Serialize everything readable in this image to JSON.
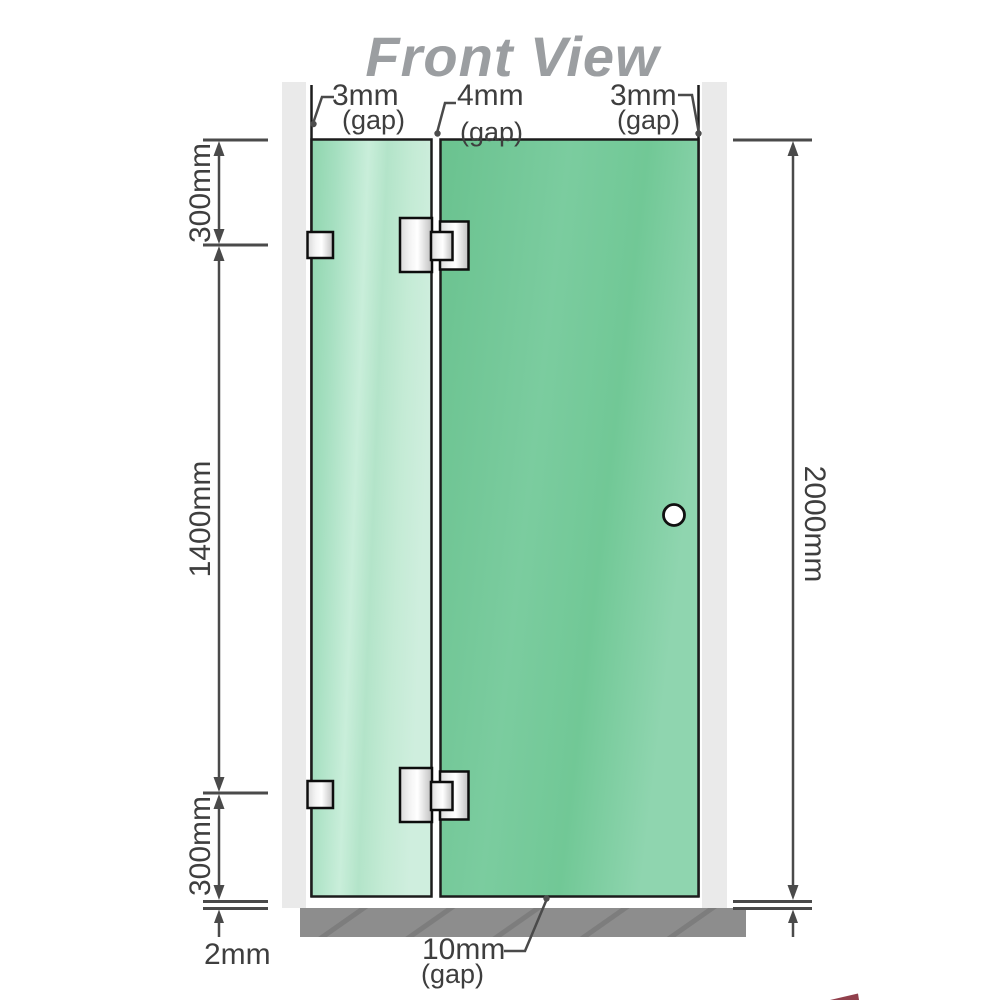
{
  "title": "Front View",
  "top_gaps": {
    "left": {
      "value": "3mm",
      "note": "(gap)"
    },
    "middle": {
      "value": "4mm",
      "note": "(gap)"
    },
    "right": {
      "value": "3mm",
      "note": "(gap)"
    }
  },
  "left_dimensions": {
    "top": "300mm",
    "middle": "1400mm",
    "bottom": "300mm"
  },
  "right_dimension": "2000mm",
  "bottom_dimensions": {
    "floor_gap": "2mm",
    "door_gap": {
      "value": "10mm",
      "note": "(gap)"
    }
  },
  "colors": {
    "glass_fixed_panel": "#a9e1c3",
    "glass_door_panel": "#74c999",
    "wall_channel": "#eaeaea",
    "floor": "#8d8d8d",
    "dimension_lines": "#4a4a4a",
    "label_text": "#3e3e3e",
    "title_text": "#9b9ea1",
    "hardware_outline": "#111111"
  }
}
